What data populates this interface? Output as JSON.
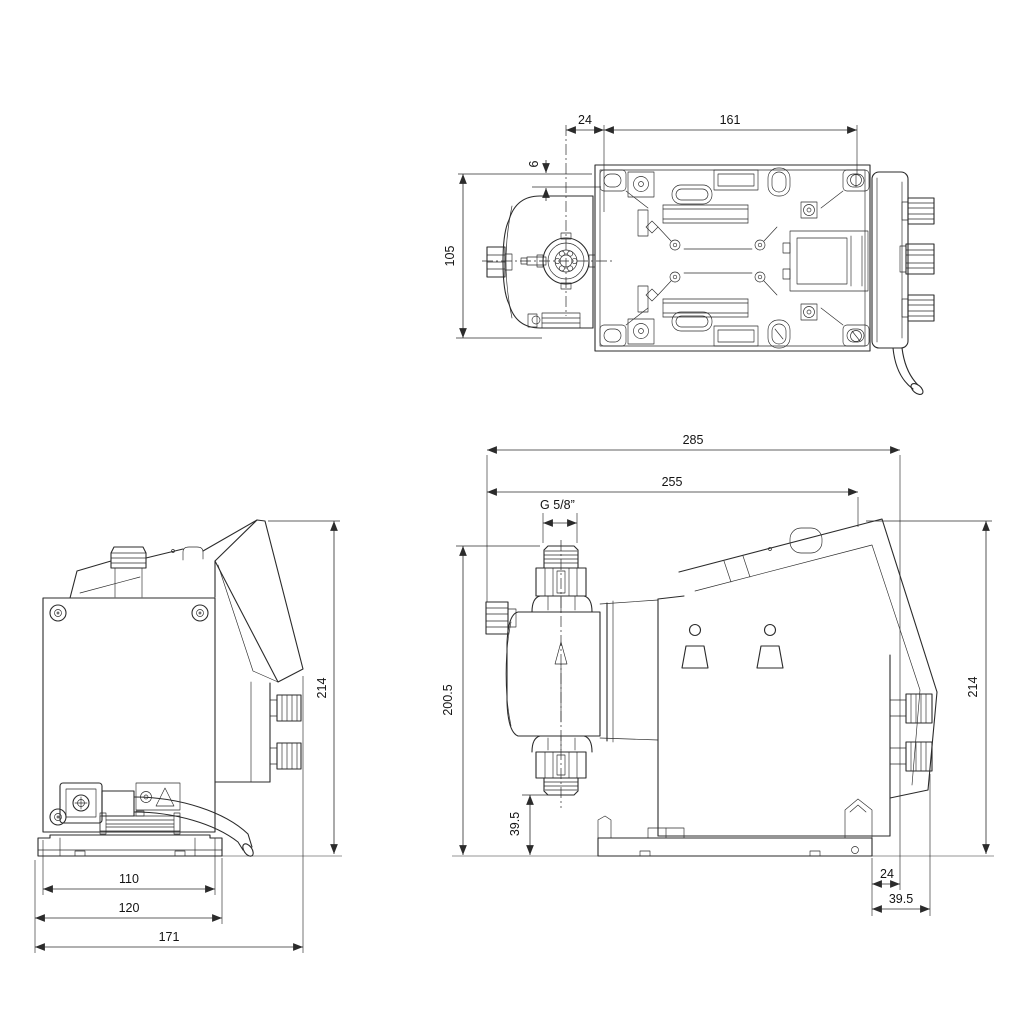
{
  "drawing": {
    "type": "technical-dimensional-drawing",
    "subject": "diaphragm dosing pump, three orthographic views",
    "colors": {
      "line": "#2b2b2b",
      "background": "#ffffff",
      "text": "#141414"
    },
    "views": {
      "top_view": {
        "dimensions": {
          "valve_to_plate_offset": "24",
          "mounting_hole_spacing": "161",
          "edge_offset": "6",
          "overall_width": "105"
        }
      },
      "rear_view": {
        "dimensions": {
          "mounting_plate_width": "110",
          "base_width": "120",
          "overall_depth": "171",
          "overall_height": "214"
        }
      },
      "side_view": {
        "dimensions": {
          "overall_length": "285",
          "body_length": "255",
          "connection_thread": "G 5/8”",
          "valve_top_height": "200.5",
          "valve_bottom_clearance": "39.5",
          "overall_height": "214",
          "base_to_rear_offset": "24",
          "rear_connector_depth": "39.5"
        }
      }
    }
  }
}
